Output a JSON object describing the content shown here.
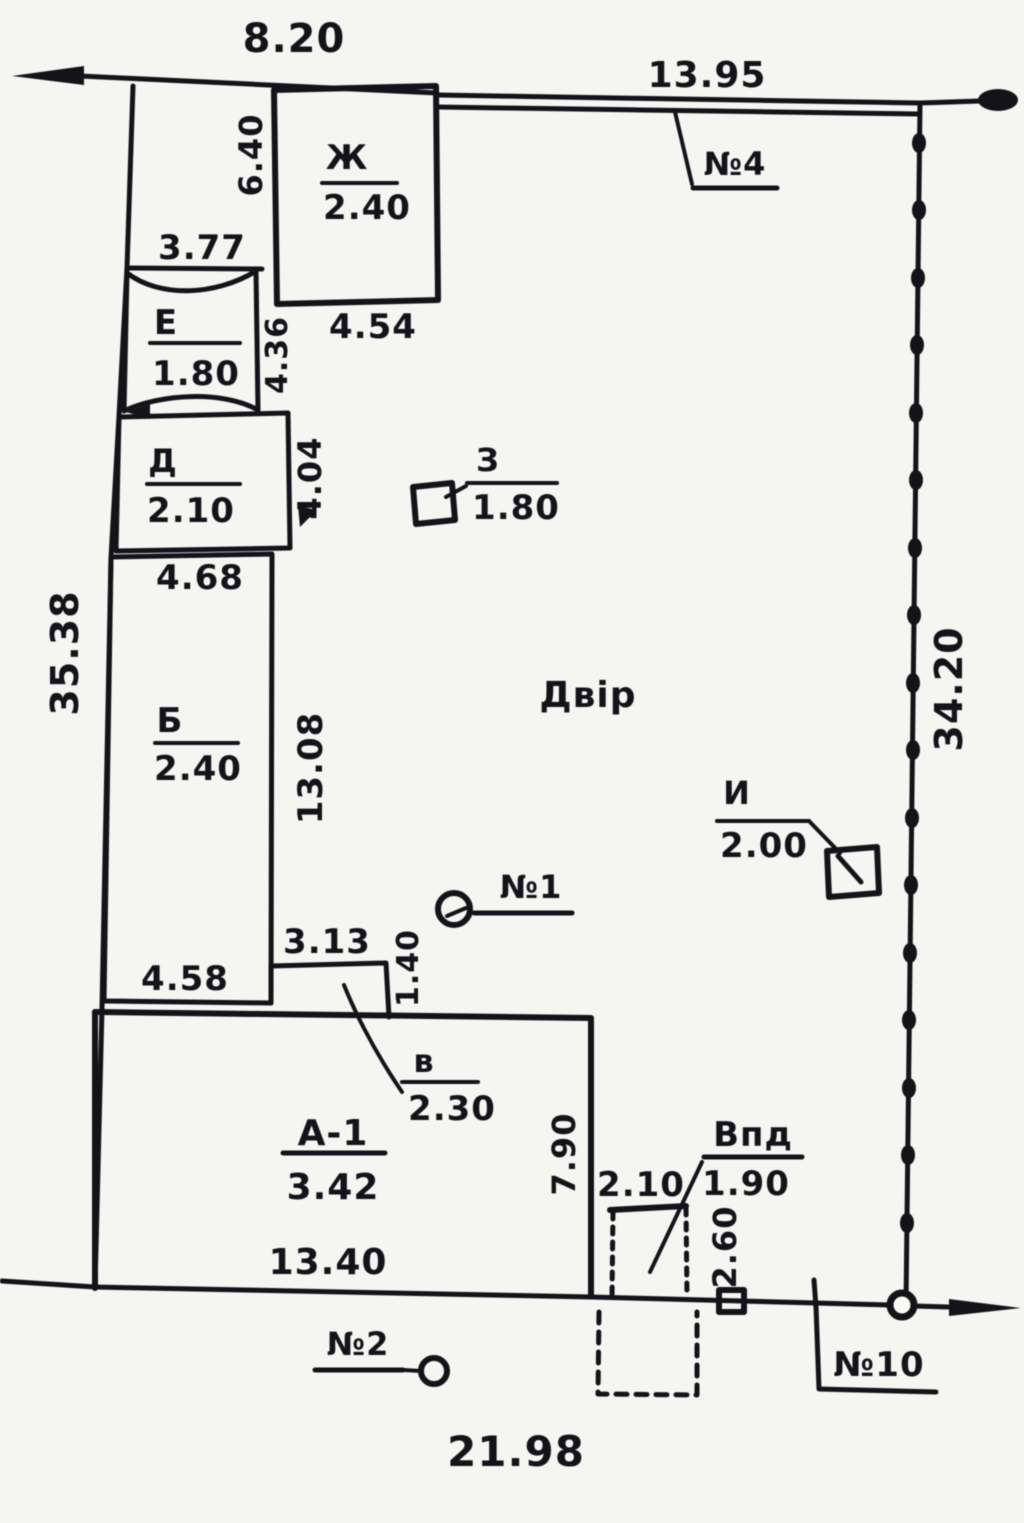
{
  "dims": {
    "top": "8.20",
    "top_right": "13.95",
    "left": "35.38",
    "right": "34.20",
    "bottom": "21.98",
    "courtyard_height": "6.40",
    "e_width": "3.77",
    "zh_width": "4.54",
    "e_height": "4.36",
    "d_height": "4.04",
    "d_width": "4.68",
    "b_height": "13.08",
    "b_width": "4.58",
    "v_width": "3.13",
    "v_height": "1.40",
    "a1_width": "13.40",
    "a1_height": "7.90",
    "vpd_offset": "2.10",
    "vpd_height": "2.60"
  },
  "buildings": {
    "zh": {
      "letter": "Ж",
      "value": "2.40"
    },
    "e": {
      "letter": "Е",
      "value": "1.80"
    },
    "d": {
      "letter": "Д",
      "value": "2.10"
    },
    "b": {
      "letter": "Б",
      "value": "2.40"
    },
    "z": {
      "letter": "З",
      "value": "1.80"
    },
    "i": {
      "letter": "И",
      "value": "2.00"
    },
    "v": {
      "letter": "в",
      "value": "2.30"
    },
    "a1": {
      "letter": "А-1",
      "value": "3.42"
    },
    "vpd": {
      "letter": "Впд",
      "value": "1.90"
    }
  },
  "markers": {
    "n1": "№1",
    "n2": "№2",
    "n4": "№4",
    "n10": "№10"
  },
  "labels": {
    "yard": "Двір"
  },
  "colors": {
    "ink": "#17171d",
    "paper": "#f5f5f2"
  }
}
